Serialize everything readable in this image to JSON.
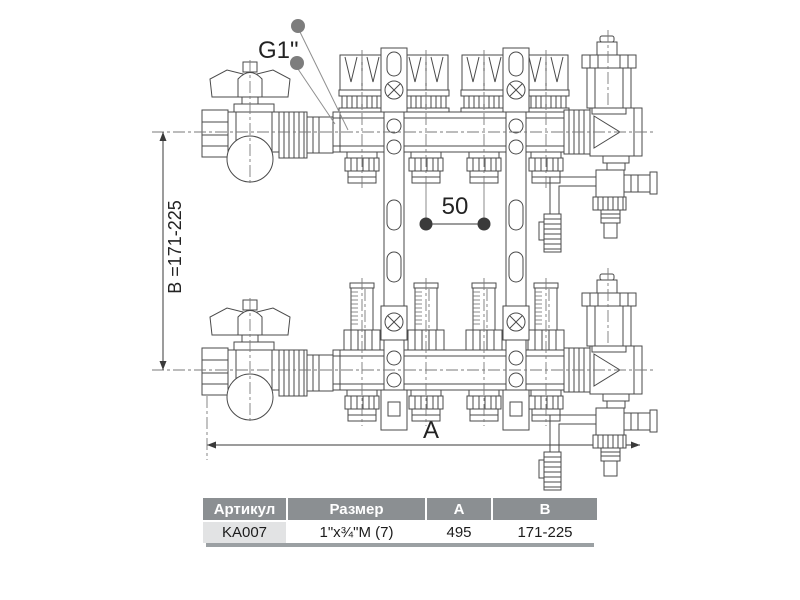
{
  "drawing": {
    "labels": {
      "thread_size": "G1\"",
      "height_range": "B =171-225",
      "outlet_spacing": "50",
      "length": "A"
    },
    "colors": {
      "line": "#4a4a4a",
      "dimension": "#3a3a3a",
      "marker_dot": "#7d7d7d"
    }
  },
  "table": {
    "headers": [
      "Артикул",
      "Размер",
      "A",
      "B"
    ],
    "rows": [
      [
        "KA007",
        "1\"x¾\"M (7)",
        "495",
        "171-225"
      ]
    ],
    "colors": {
      "header_bg": "#8b8f92",
      "header_text": "#ffffff",
      "article_cell_bg": "#e2e3e4",
      "shadow": "#9ba0a3"
    }
  }
}
